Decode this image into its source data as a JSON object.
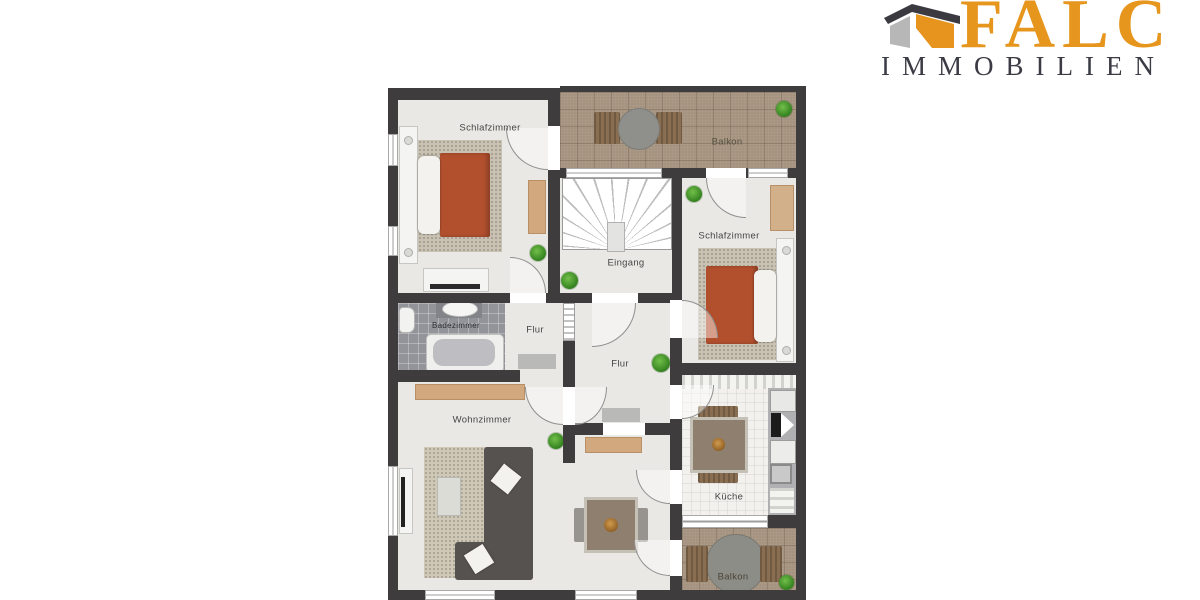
{
  "logo": {
    "brand": "FALC",
    "subtitle": "IMMOBILIEN",
    "brand_color": "#E6951D",
    "subtitle_color": "#3B3B45",
    "house_roof_color": "#3A3A40",
    "house_left_color": "#B7B7B7",
    "house_right_color": "#E6941E"
  },
  "floorplan": {
    "wall_color": "#3E3C3D",
    "room_floor_color": "#E9E8E4",
    "balcony_tile_color": "#A5937F",
    "bath_tile_color": "#93939A",
    "kitchen_floor_color": "#F2F1ED",
    "bed_blanket_color": "#B2502E",
    "wood_accent_color": "#D2A87F",
    "sofa_color": "#56524F",
    "plant_color": "#3F9E2F",
    "rooms": [
      {
        "id": "schlafzimmer-1",
        "label": "Schlafzimmer"
      },
      {
        "id": "balkon-oben",
        "label": "Balkon"
      },
      {
        "id": "eingang",
        "label": "Eingang"
      },
      {
        "id": "schlafzimmer-2",
        "label": "Schlafzimmer"
      },
      {
        "id": "badezimmer",
        "label": "Badezimmer"
      },
      {
        "id": "flur-klein",
        "label": "Flur"
      },
      {
        "id": "flur",
        "label": "Flur"
      },
      {
        "id": "wohnzimmer",
        "label": "Wohnzimmer"
      },
      {
        "id": "kueche",
        "label": "Küche"
      },
      {
        "id": "balkon-unten",
        "label": "Balkon"
      }
    ]
  }
}
